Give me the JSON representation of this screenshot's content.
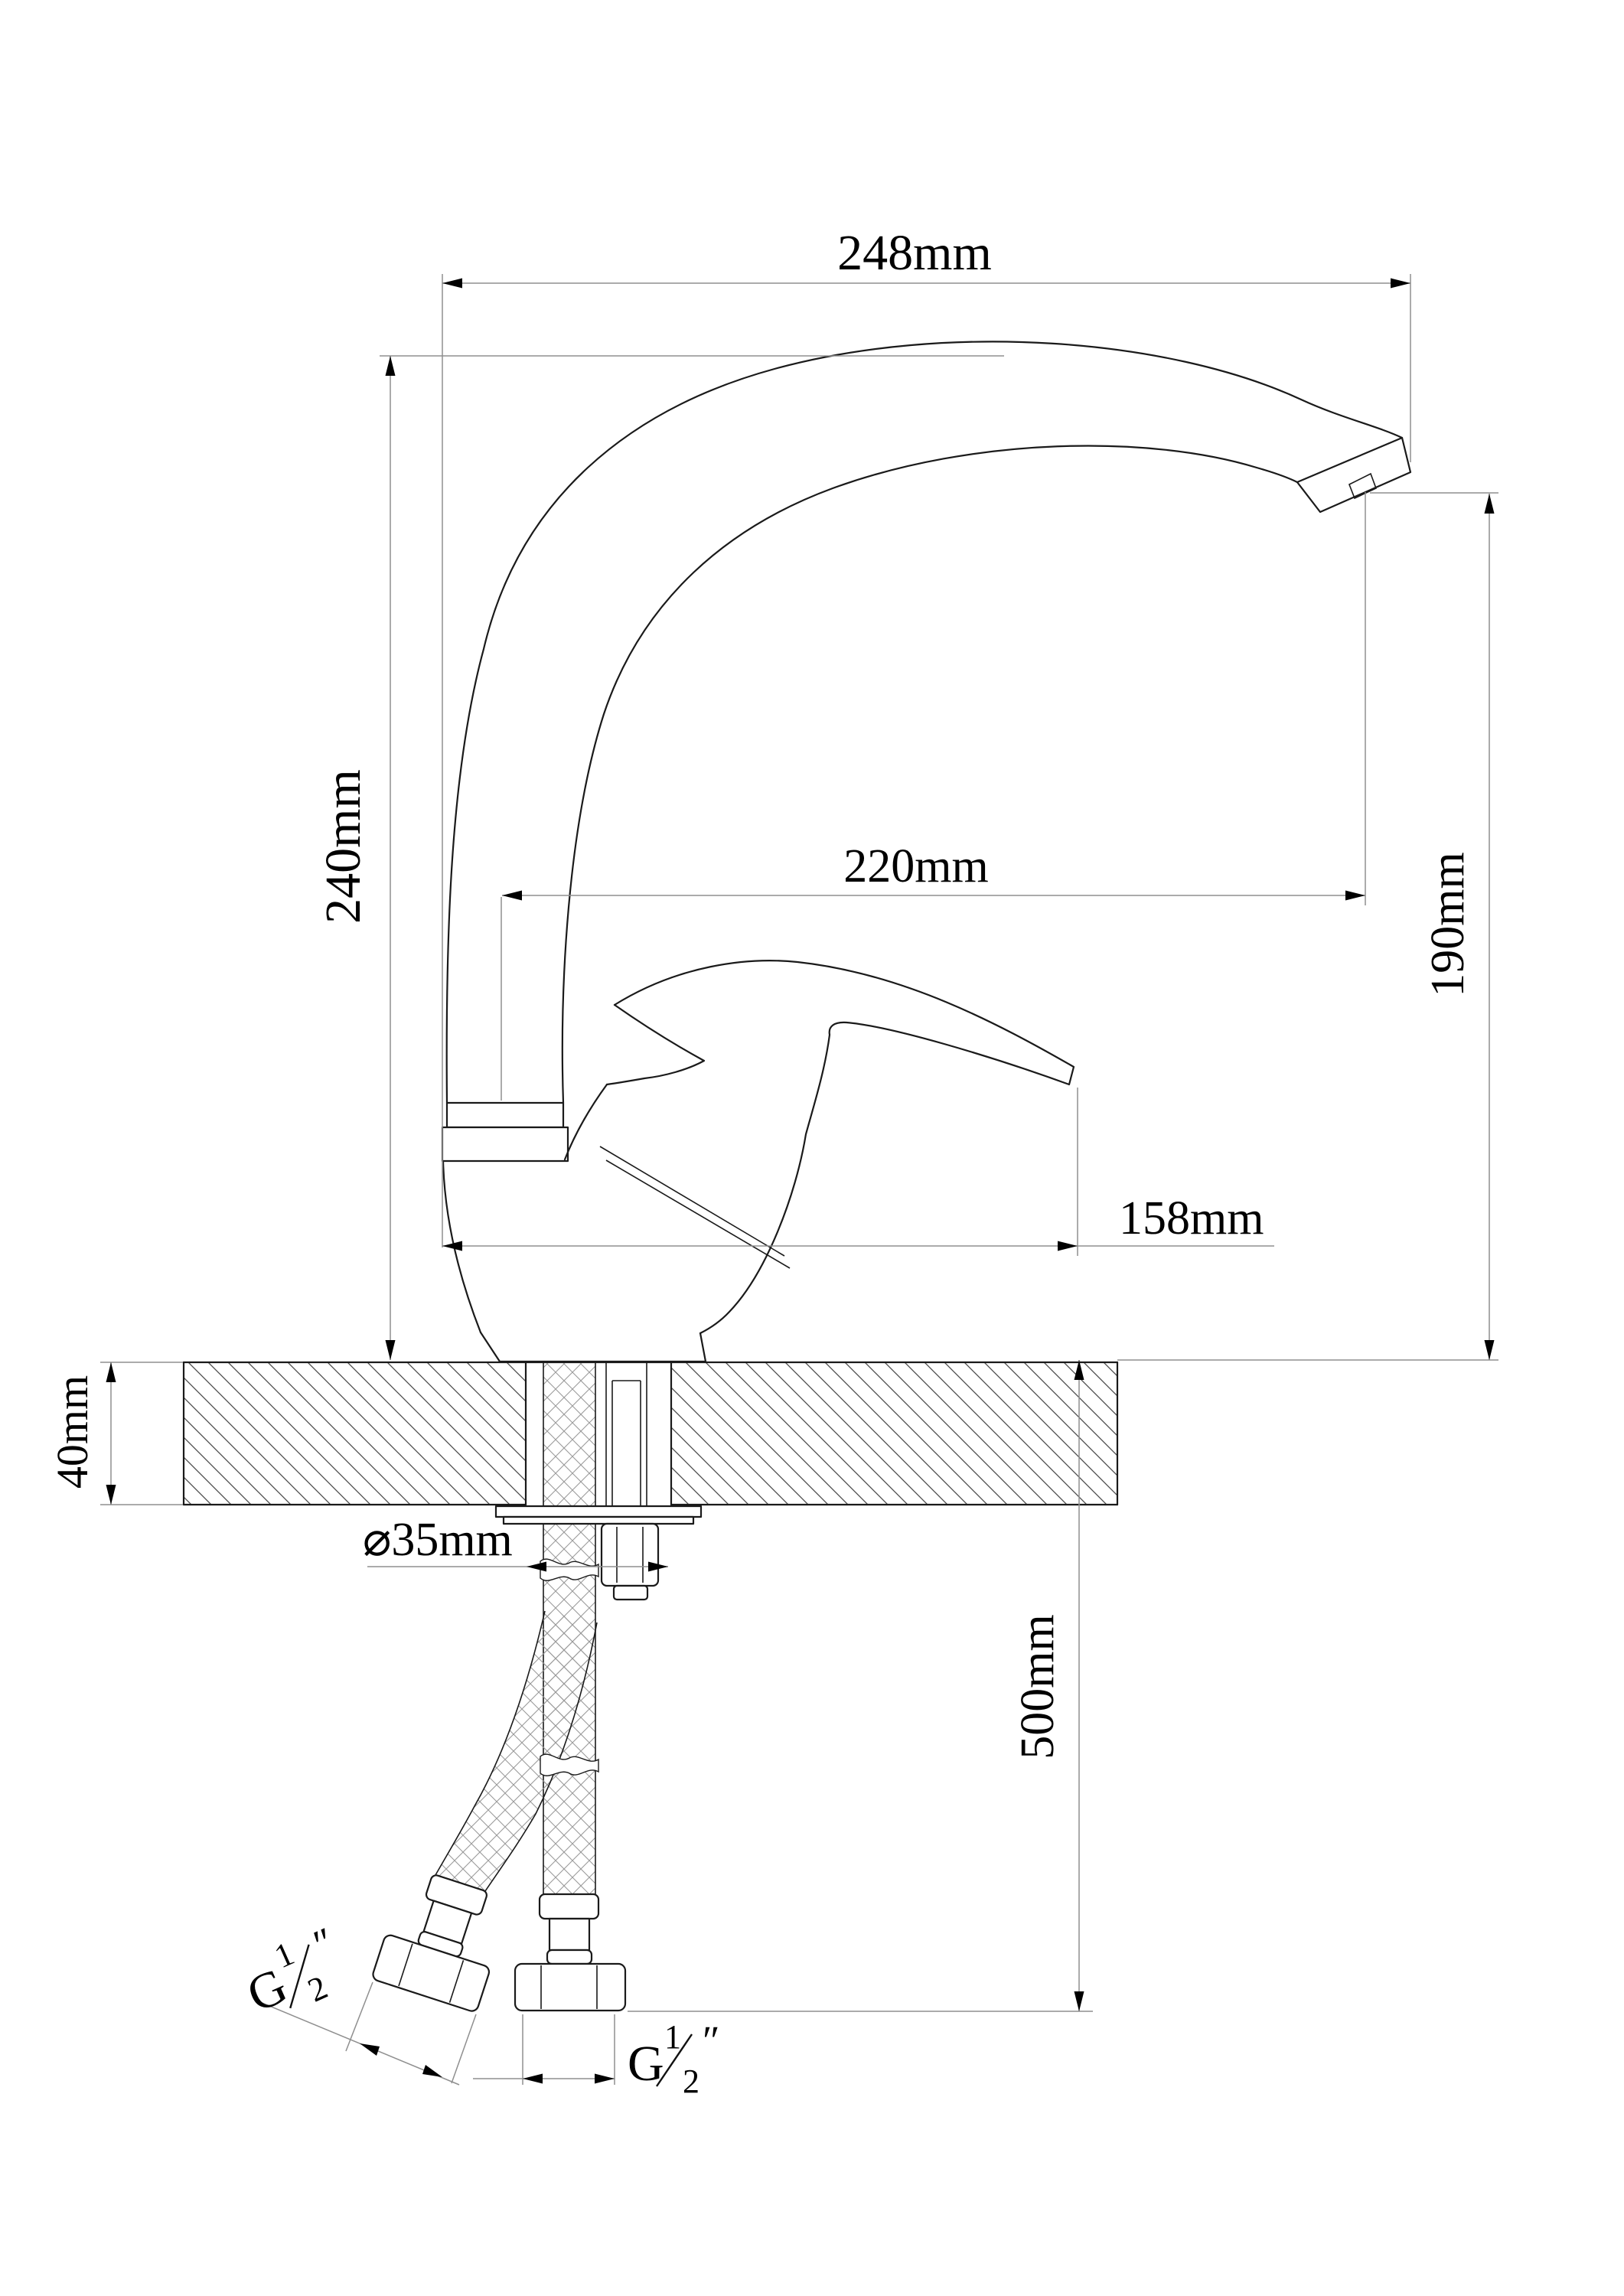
{
  "drawing": {
    "type": "faucet-dimension-drawing",
    "colors": {
      "object_line": "#1a1a1a",
      "dimension_line": "#8f8f8f",
      "text": "#000000",
      "background": "#ffffff"
    },
    "dimensions": {
      "spout_reach": {
        "label": "248mm"
      },
      "spout_height": {
        "label": "240mm"
      },
      "outlet_reach": {
        "label": "220mm"
      },
      "outlet_height": {
        "label": "190mm"
      },
      "body_length": {
        "label": "158mm"
      },
      "counter_thickness": {
        "label": "40mm"
      },
      "hole_diameter": {
        "label": "⌀35mm"
      },
      "hose_length": {
        "label": "500mm"
      },
      "left_hose_thread": {
        "prefix": "G",
        "numerator": "1",
        "denominator": "2",
        "unit": "″"
      },
      "right_hose_thread": {
        "prefix": "G",
        "numerator": "1",
        "denominator": "2",
        "unit": "″"
      }
    }
  }
}
